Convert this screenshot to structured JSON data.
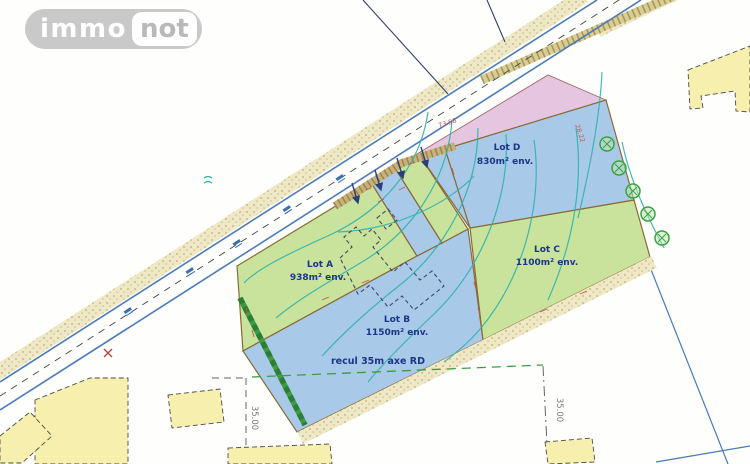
{
  "logo": {
    "immo": "immo",
    "not": "not"
  },
  "plan": {
    "lots": [
      {
        "name": "Lot A",
        "area": "938m² env."
      },
      {
        "name": "Lot B",
        "area": "1150m² env."
      },
      {
        "name": "Lot C",
        "area": "1100m² env."
      },
      {
        "name": "Lot D",
        "area": "830m² env."
      }
    ],
    "setback_note": "recul 35m axe RD",
    "dimensions": {
      "road": "73.56",
      "east": "28.22",
      "left": "35.00",
      "right": "35.00"
    },
    "colors": {
      "lot_green": "#c9e29c",
      "lot_blue": "#a9c9e9",
      "strip_pink": "#e4c6e1",
      "building": "#f7efad",
      "contour": "#2fb3ab",
      "boundary": "#8a6a35",
      "dim_red": "#c4574a",
      "label_blue": "#1d3587",
      "road_blue": "#4a7ab8",
      "hedge_green": "#3c9c44"
    }
  }
}
